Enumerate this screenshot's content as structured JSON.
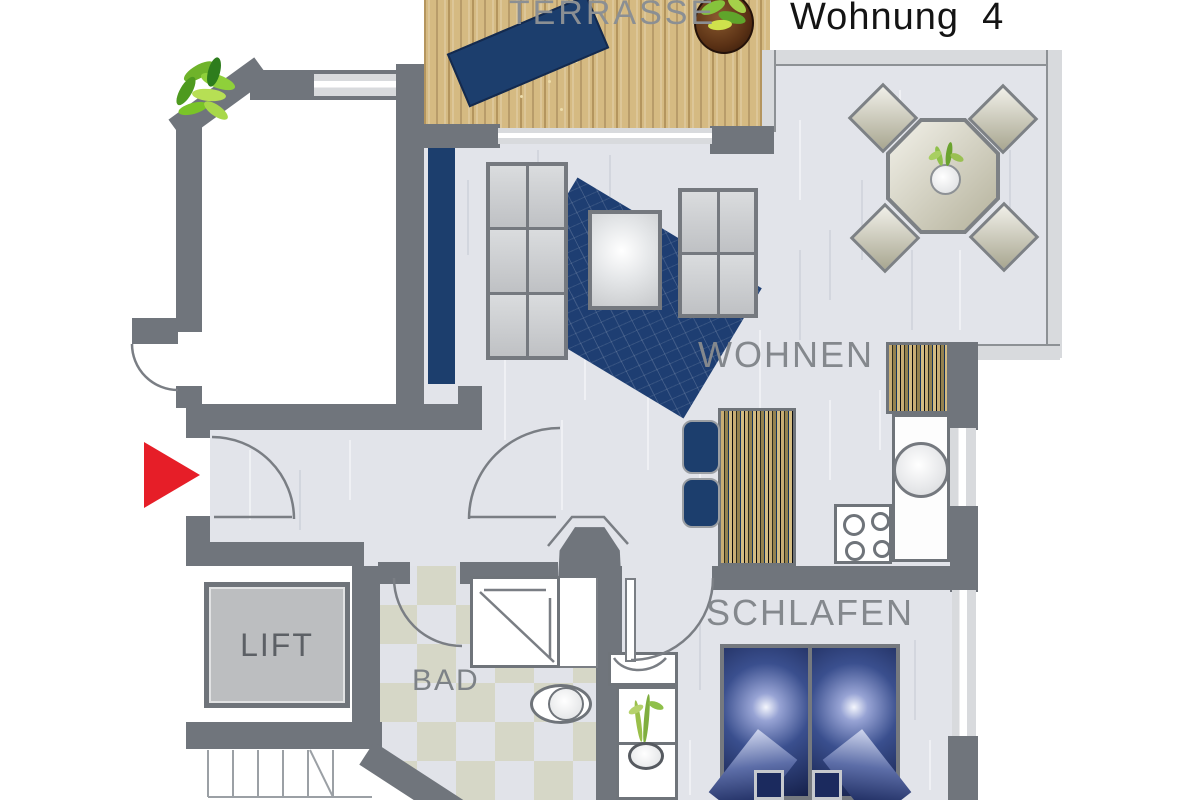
{
  "title": "Wohnung  4",
  "rooms": {
    "terrace": "TERRASSE",
    "living": "WOHNEN",
    "sleeping": "SCHLAFEN",
    "bath": "BAD",
    "lift": "LIFT"
  },
  "colors": {
    "wall": "#70757c",
    "floor": "#e2e4ea",
    "glass": "#d8dadd",
    "wood": "#d5ba82",
    "navy": "#1c3e6d",
    "rug": "#1e3e72",
    "red": "#e61e28",
    "tile": "#d6d7c7",
    "label": "#84888d",
    "title_text": "#141414"
  }
}
